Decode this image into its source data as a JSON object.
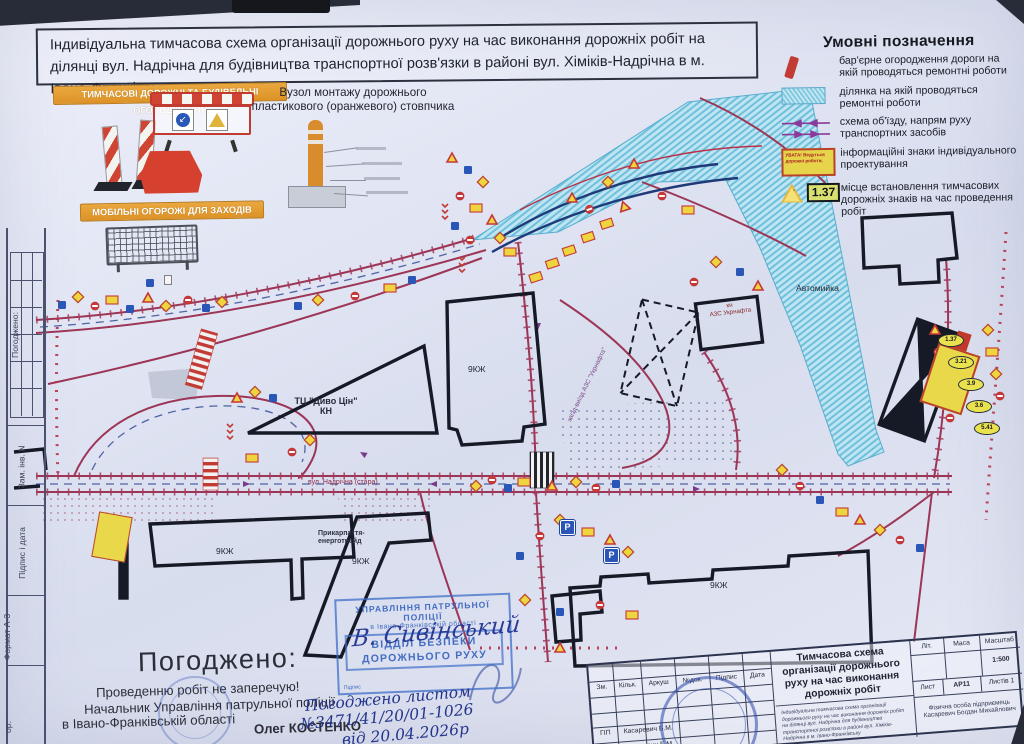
{
  "sheet": {
    "title": "Індивідуальна тимчасова схема організації дорожнього руху на час виконання дорожніх робіт на ділянці вул. Надрічна для будівництва транспортної розв'язки в районі вул. Хіміків-Надрічна в м. Івано-Франківську"
  },
  "legend": {
    "heading": "Умовні позначення",
    "items": [
      {
        "icon": "barrier-bar-icon",
        "text": "бар'єрне  огородження дороги на якій проводяться ремонтні роботи"
      },
      {
        "icon": "hatched-area-icon",
        "text": "ділянка на якій проводяться ремонтні роботи"
      },
      {
        "icon": "detour-arrows-icon",
        "text": "схема об'їзду, напрям руху транспортних засобів"
      },
      {
        "icon": "info-sign-icon",
        "icon_text": "УВАГА! Ведуться дорожні роботи.",
        "text": "інформаційні знаки індивідуального проектування"
      },
      {
        "icon": "roadworks-sign-icon",
        "icon_text": "1.37",
        "text": "місце встановлення тимчасових дорожніх знаків на час проведення робіт"
      }
    ]
  },
  "fencing": {
    "banner_top": "ТИМЧАСОВІ ДОРОЖНІ ТА БУДІВЕЛЬНІ ОГОРОДЖЕННЯ",
    "banner_bottom": "МОБІЛЬНІ ОГОРОЖІ ДЛЯ ЗАХОДІВ"
  },
  "bollard": {
    "title": "Вузол монтажу дорожнього пластикового (оранжевого) стовпчика"
  },
  "map": {
    "street_main": "вул. Надрічна (стара)",
    "azs_access": "заїзд-виїзд АЗС \"Укрнафта\"",
    "parking": "P",
    "labels": {
      "mall": "ТЦ \"Диво Цін\"",
      "mall_sub": "КН",
      "bld_center": "9КЖ",
      "bld_left": "9КЖ",
      "bld_mid": "9КЖ",
      "bld_right": "9КЖ",
      "carwash": "Автомийка",
      "azs1": "кн",
      "azs2": "АЗС Укрнафта",
      "energo1": "Прикарпаття-",
      "energo2": "енерготрейд"
    },
    "sign_numbers": [
      "1.37",
      "3.21",
      "3.9",
      "3.6",
      "5.41"
    ]
  },
  "approval": {
    "heading": "Погоджено:",
    "line1": "Проведенню робіт не заперечую!",
    "line2": "Начальник Управління патрульної поліції",
    "line3": "в Івано-Франківській області",
    "name": "Олег КОСТЕНКО"
  },
  "police_stamp": {
    "line1": "УПРАВЛІННЯ ПАТРУЛЬНОЇ ПОЛІЦІЇ",
    "line2": "в Івано-Франківській області",
    "line3": "ВІДДІЛ БЕЗПЕКИ",
    "line4": "ДОРОЖНЬОГО РУХУ",
    "sign_label": "Підпис",
    "signature": "В. Сивінський"
  },
  "handwriting": {
    "line1": "Погоджено листом",
    "line2": "№3471/41/20/01-1026",
    "line3": "від 20.04.2026р"
  },
  "title_block": {
    "headers": [
      "Зм.",
      "Кільк.",
      "Аркуш",
      "№док.",
      "Підпис",
      "Дата"
    ],
    "title": "Тимчасова схема організації дорожнього руху на час виконання дорожніх робіт",
    "lit_label": "Літ.",
    "mass_label": "Маса",
    "scale_label": "Масштаб",
    "scale": "1:500",
    "sheet_label": "Лист",
    "sheet": "АР11",
    "sheets_label": "Листів 1",
    "person": "Фізична особа підприємець Касаревич Богдан Михайлович",
    "row1_label": "ГІП",
    "row1_name": "Касаревич Б.М.",
    "row2_label": "Розробив",
    "row2_name": "Касаревич Б.М.",
    "note": "Індивідуальна тимчасова схема організації дорожнього руху на час виконання дорожніх робіт на ділянці вул. Надрічна для будівництва транспортної розв'язки в районі вул. Хіміків-Надрічна в м. Івано-Франківську"
  },
  "side_strip": {
    "approved": "Погоджено:",
    "zam_inv": "Зам. інв. N",
    "sign_date": "Підпис і дата",
    "format": "Формат А-3",
    "inv": "ор."
  }
}
